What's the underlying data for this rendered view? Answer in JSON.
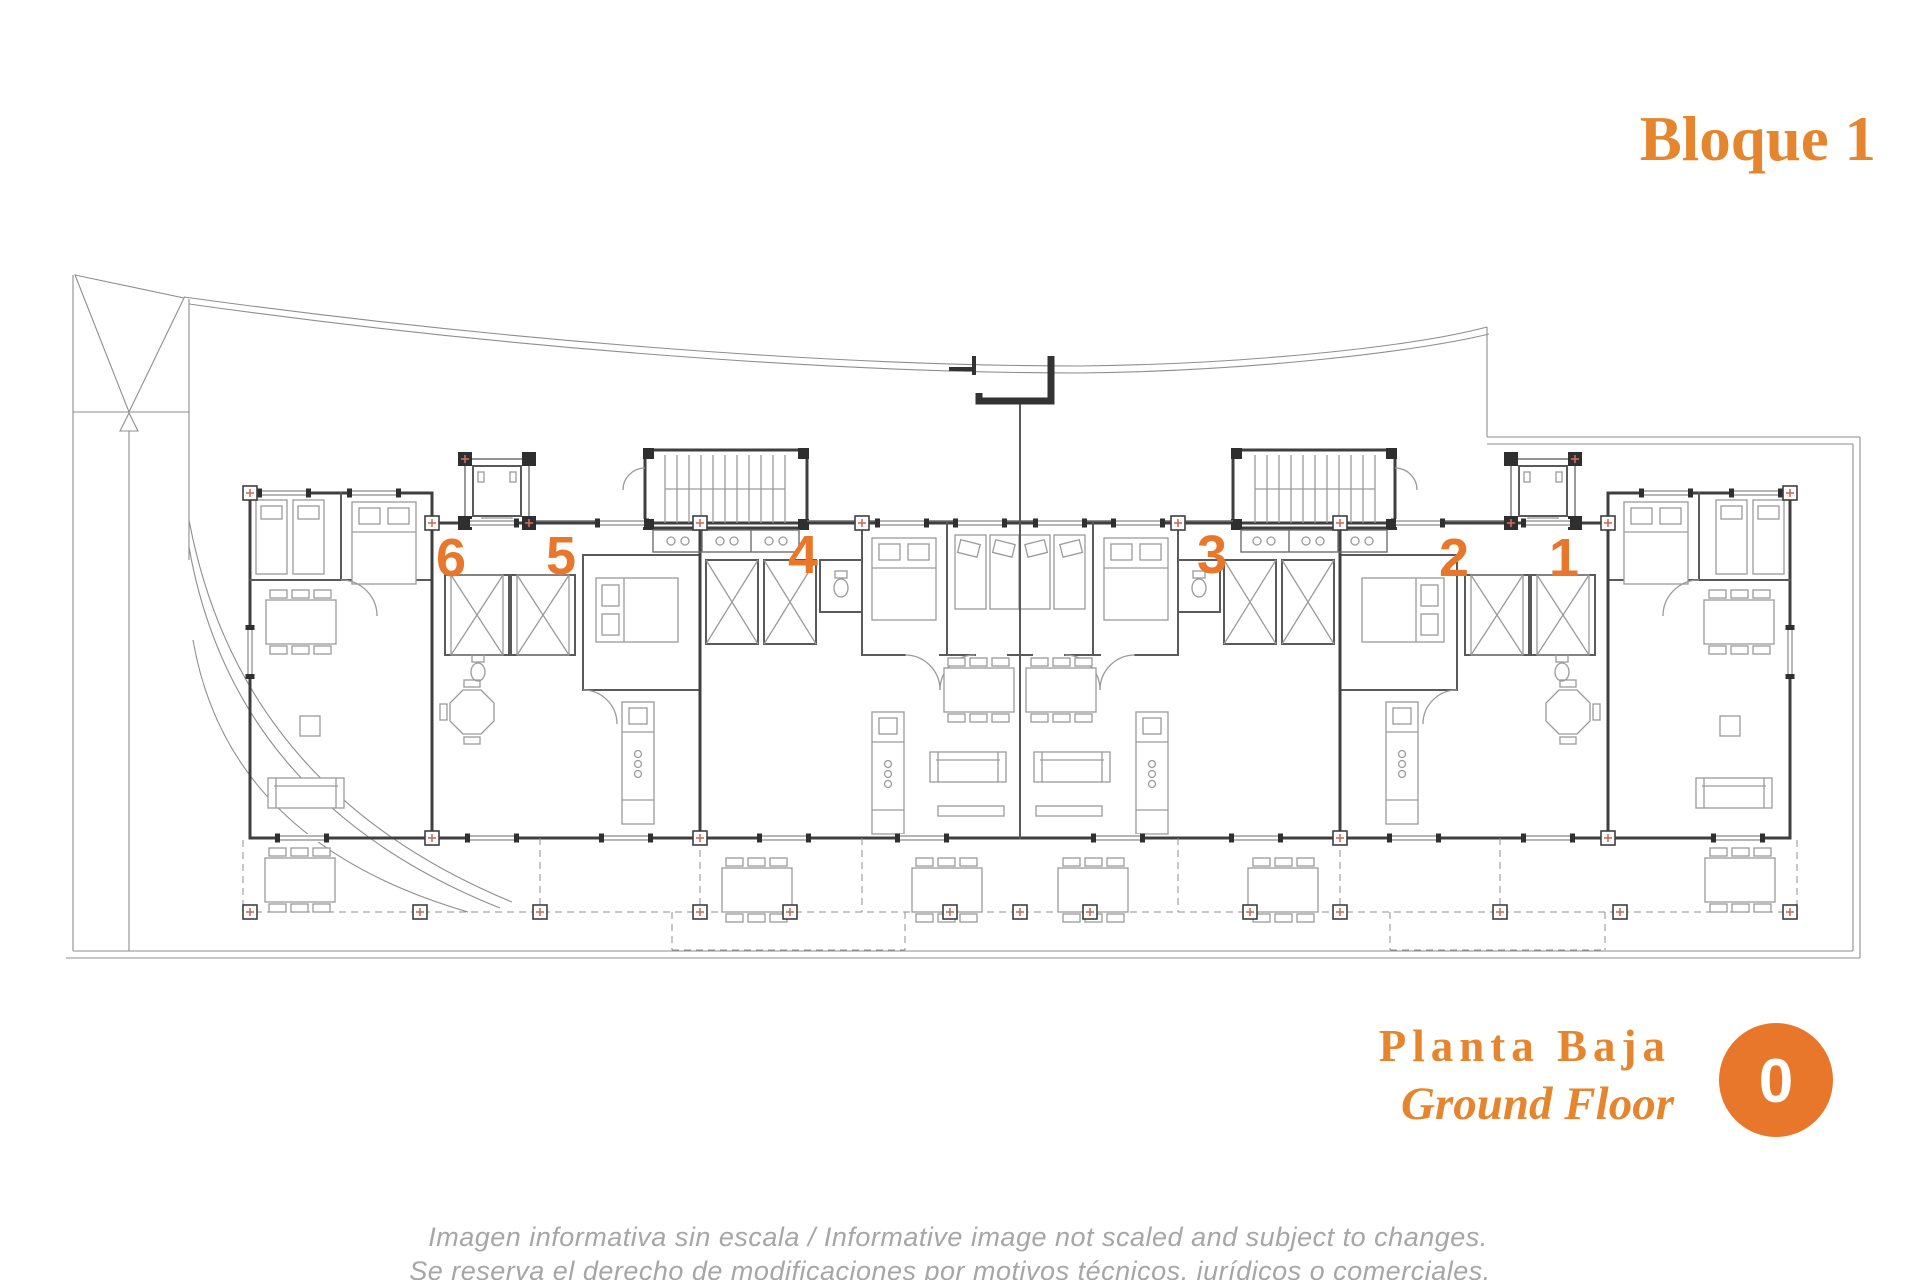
{
  "header": {
    "title": "Bloque 1"
  },
  "plan": {
    "units": [
      {
        "label": "6"
      },
      {
        "label": "5"
      },
      {
        "label": "4"
      },
      {
        "label": "3"
      },
      {
        "label": "2"
      },
      {
        "label": "1"
      }
    ]
  },
  "floor": {
    "label_es": "Planta Baja",
    "label_en": "Ground Floor",
    "badge": "0"
  },
  "disclaimer": {
    "line1": "Imagen informativa sin escala /  Informative image not scaled and subject to changes.",
    "line2": "Se reserva el derecho de modificaciones por motivos técnicos, jurídicos o comerciales."
  },
  "colors": {
    "accent_orange": "#E8772B",
    "title_orange": "#E5862F",
    "disclaimer_gray": "#A6A6A6",
    "wall_dark": "#3F3F3F",
    "marker_red": "#C9705F"
  }
}
